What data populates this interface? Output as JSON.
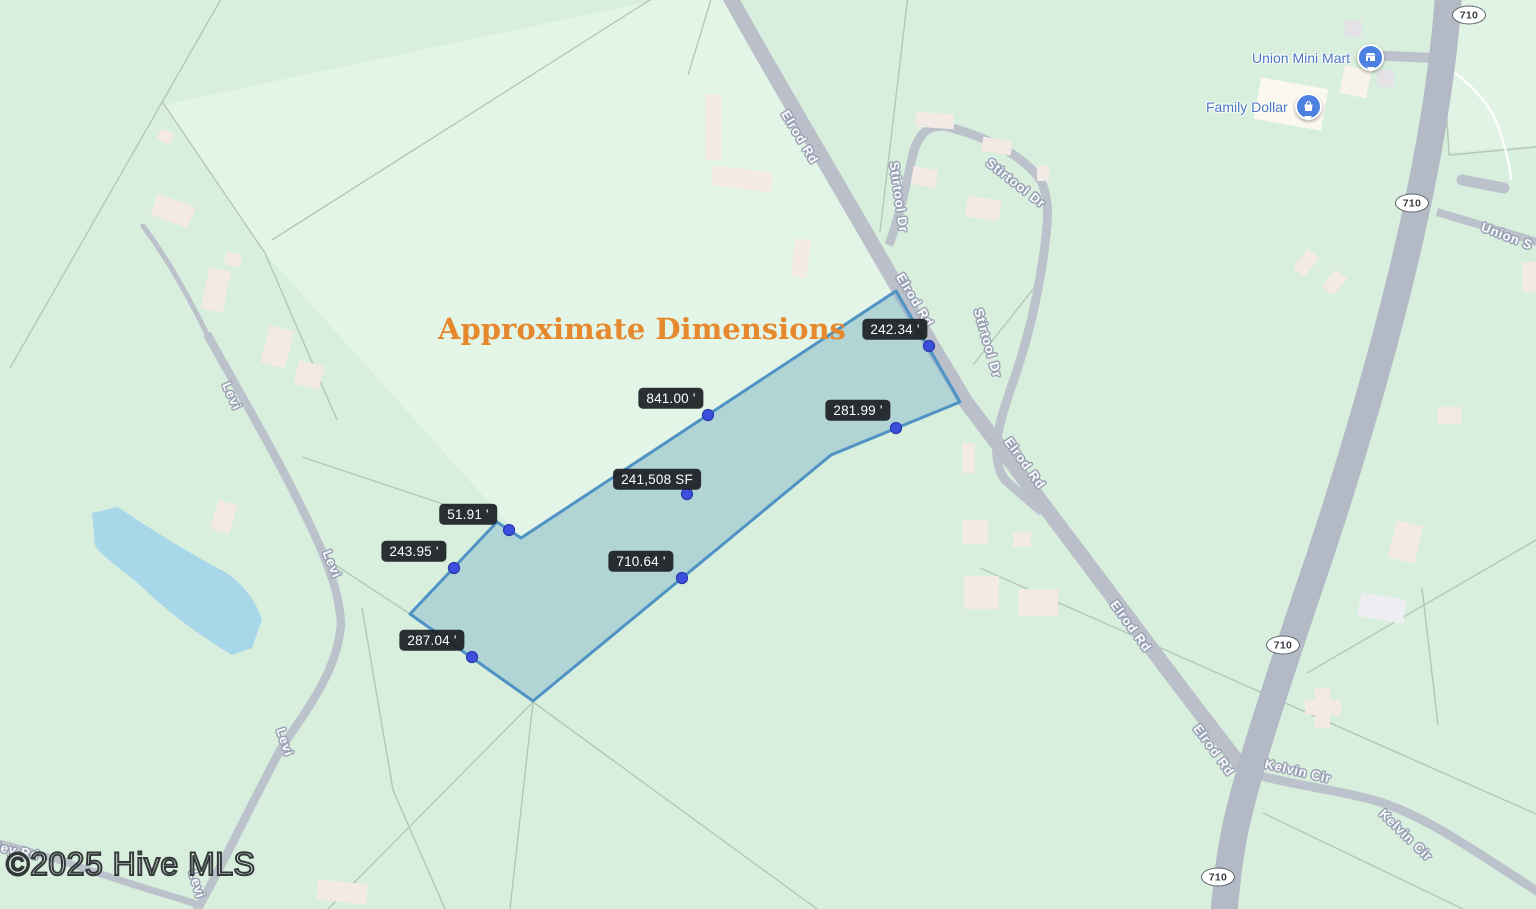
{
  "map": {
    "title": "Approximate Dimensions",
    "watermark": "©2025 Hive MLS",
    "parcel": {
      "area_label": "241,508 SF",
      "dimensions": [
        "242.34 '",
        "841.00 '",
        "281.99 '",
        "51.91 '",
        "243.95 '",
        "710.64 '",
        "287.04 '"
      ]
    },
    "roads": {
      "elrod": "Elrod Rd",
      "stirtool": "Stirtool Dr",
      "levi": "Levi",
      "kelvin": "Kelvin Cir",
      "union_partial": "Union S",
      "ley_partial": "ley Rd",
      "route_shield": "710"
    },
    "pois": {
      "union_mini_mart": "Union Mini Mart",
      "family_dollar": "Family Dollar"
    },
    "colors": {
      "background_green": "#d9efdd",
      "light_lot_green": "#e3f5e6",
      "road_gray": "#b9bfca",
      "highway_gray": "#b3b9c5",
      "water_blue": "#a8d7e9",
      "building_pink": "#f3eae6",
      "parcel_fill": "rgba(121,174,203,0.42)",
      "parcel_stroke": "#4f93c5",
      "vertex_dot_blue": "#3b50dd",
      "dim_label_bg": "#1c2024",
      "title_orange": "#e5882e",
      "poi_blue": "#4c80e1"
    }
  }
}
